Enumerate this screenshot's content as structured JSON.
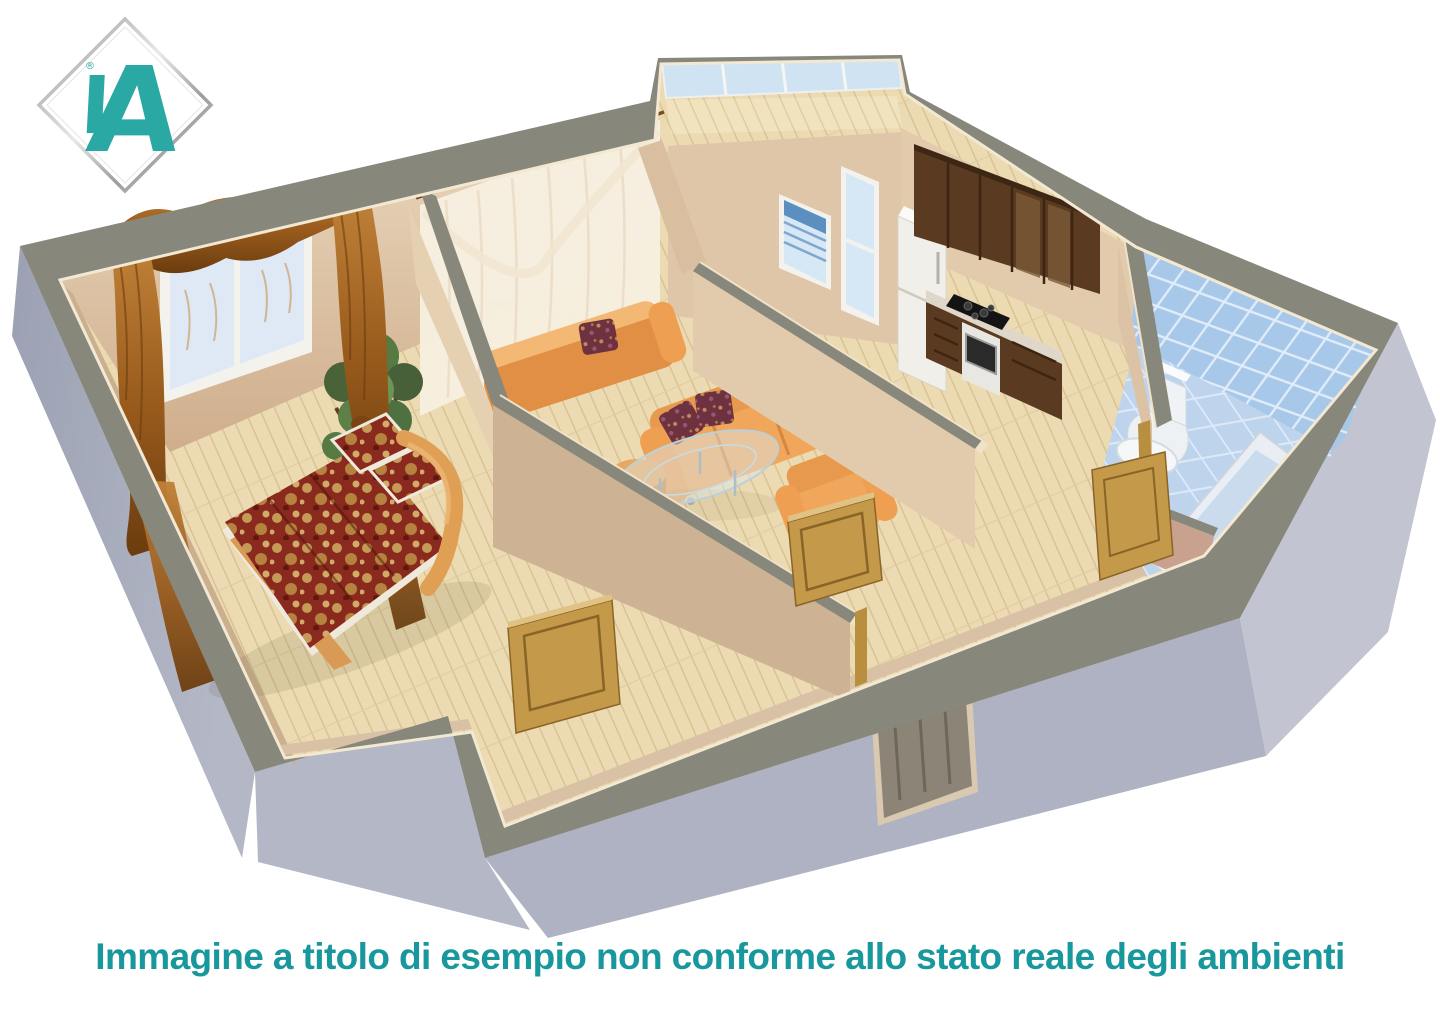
{
  "caption": {
    "text": "Immagine a titolo di esempio non conforme allo stato reale degli ambienti",
    "color": "#18989d"
  },
  "logo": {
    "letter": "A",
    "subtext": "GROUP R.E.",
    "registered": "®",
    "teal": "#2aa8a3",
    "frame": "diamond-silver"
  },
  "scene": {
    "type": "3d-floorplan-cutaway-render",
    "rooms": [
      {
        "name": "bedroom",
        "furniture": [
          "double-bed-floral-burgundy",
          "wood-headboard",
          "potted-plant",
          "window-two-panes",
          "brown-valance-curtains"
        ]
      },
      {
        "name": "living-room",
        "furniture": [
          "orange-sofa-back-view",
          "orange-sofa-front",
          "orange-armchair",
          "glass-coffee-table",
          "orange-ottoman",
          "sheer-white-curtains"
        ]
      },
      {
        "name": "kitchen",
        "furniture": [
          "walnut-upper-cabinets",
          "walnut-base-cabinets",
          "white-fridge",
          "oven-with-black-cooktop",
          "window-with-blinds",
          "glazed-balcony-door"
        ]
      },
      {
        "name": "balcony",
        "furniture": [
          "glazed-panels"
        ]
      },
      {
        "name": "bathroom",
        "furniture": [
          "blue-wall-tiles",
          "toilet",
          "washbasin",
          "bathtub",
          "wood-door"
        ]
      },
      {
        "name": "hallway",
        "furniture": [
          "open-wood-door",
          "open-wood-door",
          "entrance-door"
        ]
      }
    ],
    "palette": {
      "wall_cut_top": "#87877c",
      "exterior_wall": "#b2b5c4",
      "interior_wall": "#ddc3a4",
      "floor_wood": "#ecdbb2",
      "cream_edge": "#f3e8d2",
      "sofa_orange": "#f0a75c",
      "bed_cover": "#8a2a1e",
      "curtain_brown": "#a05d20",
      "cabinet_walnut": "#5a3a20",
      "tile_blue": "#a7c8e9",
      "door_pine": "#c49a4a"
    }
  }
}
